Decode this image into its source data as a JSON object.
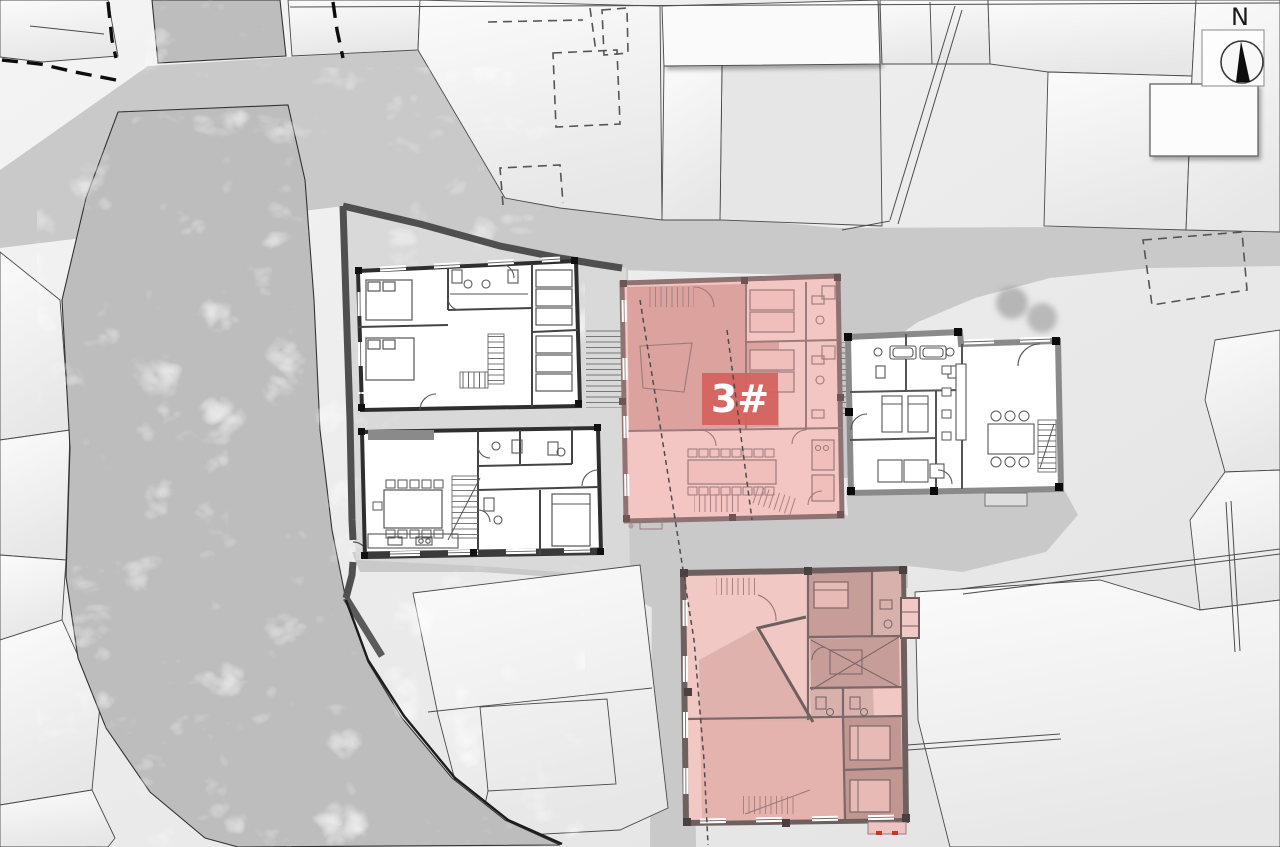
{
  "labels": {
    "north": "N",
    "highlighted_building": "3#"
  },
  "colors": {
    "highlight_pink_light": "#f3c6c3",
    "highlight_pink_dark": "#dca29e",
    "annex_pink_light": "#f2c8c5",
    "annex_pink_dark": "#c79d99",
    "badge_red": "#d4615e",
    "badge_text": "#ffffff",
    "plan_wall_black": "#2e2e2e",
    "pink_wall": "#8f7272",
    "annex_wall": "#6f6060",
    "gray_building_wall": "#8a8a8a",
    "site_wall": "#4f4f4f",
    "road_gray": "#c9c9c9",
    "river_gray": "#bdbdbd",
    "parcel_light": "#f2f2f2",
    "outline_dark": "#3f3f3f"
  }
}
